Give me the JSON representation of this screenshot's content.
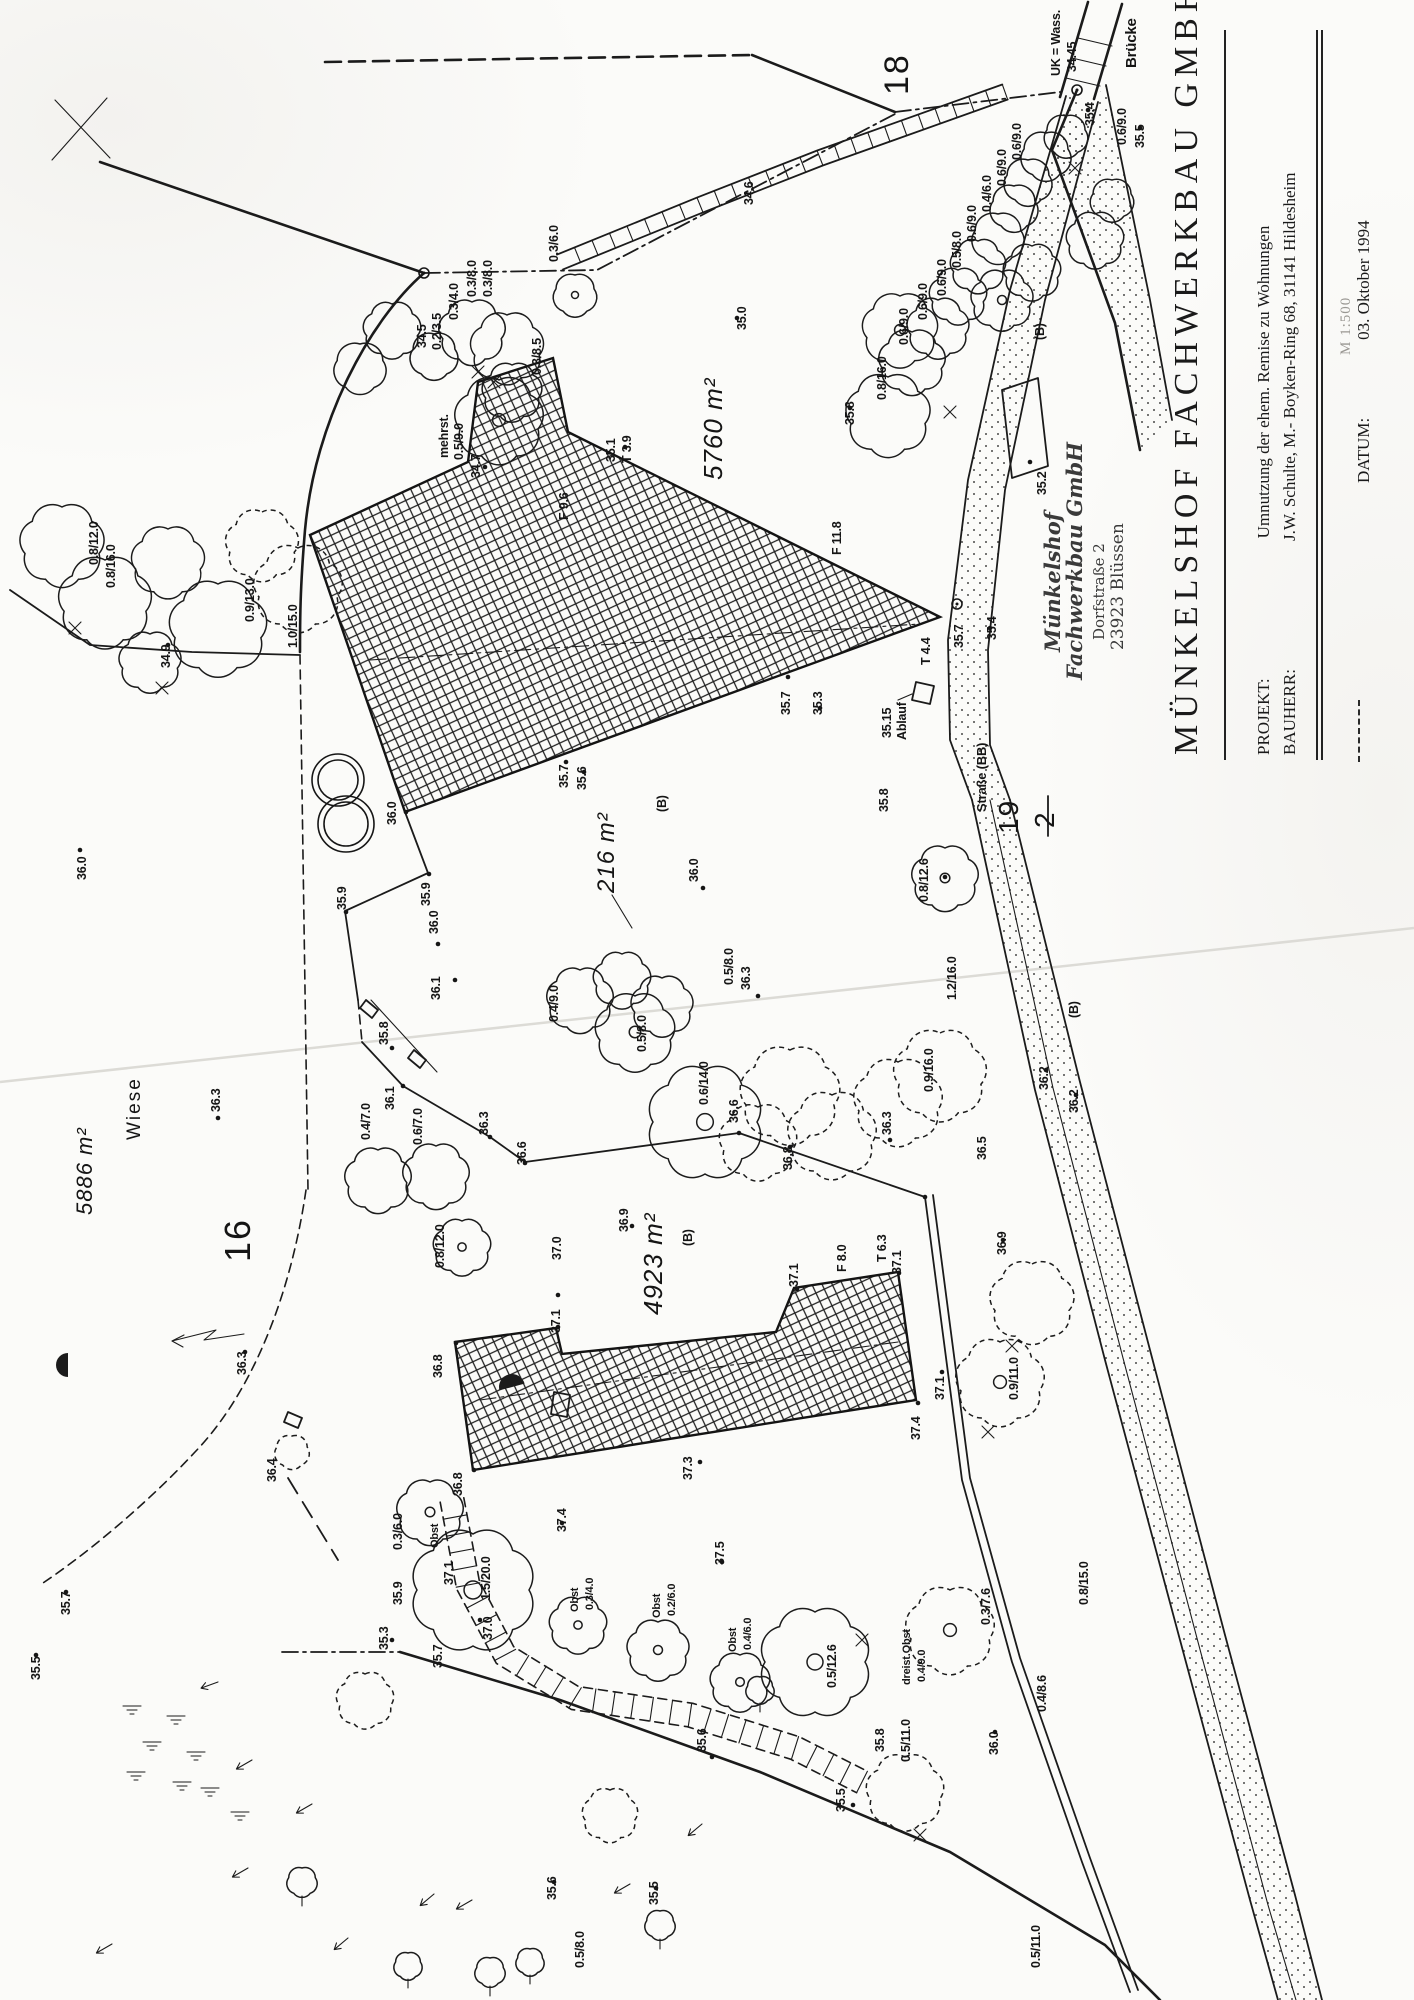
{
  "document": {
    "type": "Lageplan / site plan scan",
    "colors": {
      "ink": "#1b1b1b",
      "paper": "#fbfbf9",
      "stamp": "#3a3a3a"
    }
  },
  "title_block": {
    "company": "MÜNKELSHOF FACHWERKBAU GMBH",
    "rows": [
      {
        "label": "PROJEKT:",
        "value": "Umnutzung der ehem. Remise zu Wohnungen"
      },
      {
        "label": "BAUHERR:",
        "value": "J.W. Schulte, M.- Boyken-Ring 68, 31141 Hildesheim"
      }
    ],
    "scale_note": "M 1:500",
    "datum_label": "DATUM:",
    "datum_value": "03. Oktober 1994"
  },
  "stamp": {
    "line1": "Münkelshof",
    "line2": "Fachwerkbau GmbH",
    "line3": "Dorfstraße 2",
    "line4": "23923 Blüssen"
  },
  "map": {
    "parcels": [
      "18",
      "16",
      "19/2"
    ],
    "areas": [
      "5760 m²",
      "216 m²",
      "4923 m²",
      "5886 m²"
    ],
    "fraction": {
      "num": "19",
      "den": "2",
      "x": 1018,
      "y": 834
    },
    "labels": [
      {
        "t": "UK = Wass.",
        "x": 1060,
        "y": 76
      },
      {
        "t": "34.45",
        "x": 1076,
        "y": 72
      },
      {
        "t": "Brücke",
        "x": 1136,
        "y": 68,
        "s": 15
      },
      {
        "t": "35.4",
        "x": 1094,
        "y": 126
      },
      {
        "t": "35.5",
        "x": 1144,
        "y": 148
      },
      {
        "t": "0.6/9.0",
        "x": 1126,
        "y": 145
      },
      {
        "t": "18",
        "x": 908,
        "y": 95,
        "s": 34,
        "c": "big"
      },
      {
        "t": "34.6",
        "x": 753,
        "y": 205
      },
      {
        "t": "35.0",
        "x": 746,
        "y": 330
      },
      {
        "t": "0.3/6.0",
        "x": 558,
        "y": 262
      },
      {
        "t": "0.3/8.0",
        "x": 476,
        "y": 297
      },
      {
        "t": "0.3/8.0",
        "x": 492,
        "y": 297
      },
      {
        "t": "0.3/4.0",
        "x": 458,
        "y": 320
      },
      {
        "t": "34.5",
        "x": 426,
        "y": 348
      },
      {
        "t": "0.2/3.5",
        "x": 441,
        "y": 350
      },
      {
        "t": "0.3/8.5",
        "x": 541,
        "y": 375
      },
      {
        "t": "mehrst.",
        "x": 448,
        "y": 458
      },
      {
        "t": "0.5/9.0",
        "x": 463,
        "y": 460
      },
      {
        "t": "34.7",
        "x": 480,
        "y": 478
      },
      {
        "t": "35.1",
        "x": 615,
        "y": 462
      },
      {
        "t": "T 3.9",
        "x": 631,
        "y": 463
      },
      {
        "t": "F 9.6",
        "x": 568,
        "y": 520
      },
      {
        "t": "F 11.8",
        "x": 841,
        "y": 555
      },
      {
        "t": "T 4.4",
        "x": 930,
        "y": 665
      },
      {
        "t": "5760 m²",
        "x": 722,
        "y": 480,
        "s": 26,
        "c": "area"
      },
      {
        "t": "35.7",
        "x": 568,
        "y": 788
      },
      {
        "t": "35.6",
        "x": 586,
        "y": 790
      },
      {
        "t": "216 m²",
        "x": 614,
        "y": 893,
        "s": 24,
        "c": "area"
      },
      {
        "t": "(B)",
        "x": 666,
        "y": 812
      },
      {
        "t": "36.0",
        "x": 698,
        "y": 882
      },
      {
        "t": "35.7",
        "x": 790,
        "y": 715
      },
      {
        "t": "35.3",
        "x": 822,
        "y": 715
      },
      {
        "t": "35.15",
        "x": 891,
        "y": 738
      },
      {
        "t": "Ablauf",
        "x": 906,
        "y": 740
      },
      {
        "t": "35.7",
        "x": 963,
        "y": 648
      },
      {
        "t": "35.8",
        "x": 888,
        "y": 812
      },
      {
        "t": "Straße  (BB)",
        "x": 986,
        "y": 812,
        "s": 13
      },
      {
        "t": "35.2",
        "x": 1046,
        "y": 495
      },
      {
        "t": "(B)",
        "x": 1044,
        "y": 340
      },
      {
        "t": "35.4",
        "x": 996,
        "y": 640
      },
      {
        "t": "0.6/9.0",
        "x": 908,
        "y": 345
      },
      {
        "t": "0.6/9.0",
        "x": 927,
        "y": 320
      },
      {
        "t": "0.6/9.0",
        "x": 946,
        "y": 296
      },
      {
        "t": "0.5/8.0",
        "x": 961,
        "y": 268
      },
      {
        "t": "0.6/9.0",
        "x": 976,
        "y": 242
      },
      {
        "t": "0.4/6.0",
        "x": 991,
        "y": 212
      },
      {
        "t": "0.6/9.0",
        "x": 1006,
        "y": 186
      },
      {
        "t": "0.6/9.0",
        "x": 1021,
        "y": 160
      },
      {
        "t": "0.8/16.0",
        "x": 886,
        "y": 400
      },
      {
        "t": "35.8",
        "x": 854,
        "y": 425
      },
      {
        "t": "0.8/12.0",
        "x": 98,
        "y": 565
      },
      {
        "t": "0.8/16.0",
        "x": 115,
        "y": 588
      },
      {
        "t": "0.9/13.0",
        "x": 254,
        "y": 622
      },
      {
        "t": "1.0/15.0",
        "x": 297,
        "y": 648
      },
      {
        "t": "34.9",
        "x": 170,
        "y": 668
      },
      {
        "t": "36.0",
        "x": 86,
        "y": 880
      },
      {
        "t": "35.9",
        "x": 346,
        "y": 910
      },
      {
        "t": "35.9",
        "x": 430,
        "y": 906
      },
      {
        "t": "36.0",
        "x": 396,
        "y": 825
      },
      {
        "t": "36.0",
        "x": 438,
        "y": 934
      },
      {
        "t": "36.1",
        "x": 440,
        "y": 1000
      },
      {
        "t": "35.8",
        "x": 388,
        "y": 1045
      },
      {
        "t": "36.1",
        "x": 394,
        "y": 1110
      },
      {
        "t": "0.4/7.0",
        "x": 370,
        "y": 1140
      },
      {
        "t": "0.6/7.0",
        "x": 422,
        "y": 1145
      },
      {
        "t": "36.3",
        "x": 488,
        "y": 1135
      },
      {
        "t": "36.6",
        "x": 526,
        "y": 1165
      },
      {
        "t": "36.6",
        "x": 738,
        "y": 1123
      },
      {
        "t": "0.4/9.0",
        "x": 558,
        "y": 1022
      },
      {
        "t": "0.5/8.0",
        "x": 646,
        "y": 1052
      },
      {
        "t": "0.6/14.0",
        "x": 708,
        "y": 1105
      },
      {
        "t": "36.3",
        "x": 750,
        "y": 990
      },
      {
        "t": "0.5/8.0",
        "x": 733,
        "y": 985
      },
      {
        "t": "0.8/12.6",
        "x": 928,
        "y": 902
      },
      {
        "t": "1.2/16.0",
        "x": 956,
        "y": 1000
      },
      {
        "t": "0.9/16.0",
        "x": 933,
        "y": 1092
      },
      {
        "t": "36.2",
        "x": 1048,
        "y": 1090
      },
      {
        "t": "36.2",
        "x": 1078,
        "y": 1113
      },
      {
        "t": "(B)",
        "x": 1078,
        "y": 1018
      },
      {
        "t": "Wiese",
        "x": 140,
        "y": 1140,
        "s": 19,
        "c": "big"
      },
      {
        "t": "5886 m²",
        "x": 92,
        "y": 1215,
        "s": 22,
        "c": "area"
      },
      {
        "t": "16",
        "x": 250,
        "y": 1262,
        "s": 36,
        "c": "big"
      },
      {
        "t": "36.3",
        "x": 220,
        "y": 1112
      },
      {
        "t": "36.3",
        "x": 246,
        "y": 1375
      },
      {
        "t": "4923 m²",
        "x": 662,
        "y": 1315,
        "s": 26,
        "c": "area"
      },
      {
        "t": "36.9",
        "x": 628,
        "y": 1232
      },
      {
        "t": "(B)",
        "x": 692,
        "y": 1246
      },
      {
        "t": "0.8/12.0",
        "x": 444,
        "y": 1268
      },
      {
        "t": "37.0",
        "x": 561,
        "y": 1260
      },
      {
        "t": "37.1",
        "x": 560,
        "y": 1333
      },
      {
        "t": "36.8",
        "x": 442,
        "y": 1378
      },
      {
        "t": "36.8",
        "x": 462,
        "y": 1496
      },
      {
        "t": "37.3",
        "x": 692,
        "y": 1480
      },
      {
        "t": "37.1",
        "x": 798,
        "y": 1287
      },
      {
        "t": "F 8.0",
        "x": 846,
        "y": 1272
      },
      {
        "t": "T 6.3",
        "x": 886,
        "y": 1262
      },
      {
        "t": "37.1",
        "x": 901,
        "y": 1274
      },
      {
        "t": "37.4",
        "x": 920,
        "y": 1440
      },
      {
        "t": "37.1",
        "x": 944,
        "y": 1400
      },
      {
        "t": "0.9/11.0",
        "x": 1018,
        "y": 1400
      },
      {
        "t": "36.3",
        "x": 891,
        "y": 1135
      },
      {
        "t": "36.5",
        "x": 986,
        "y": 1160
      },
      {
        "t": "36.9",
        "x": 1006,
        "y": 1255
      },
      {
        "t": "36.8",
        "x": 792,
        "y": 1170
      },
      {
        "t": "36.4",
        "x": 276,
        "y": 1482
      },
      {
        "t": "35.7",
        "x": 70,
        "y": 1615
      },
      {
        "t": "35.5",
        "x": 40,
        "y": 1680
      },
      {
        "t": "0.3/6.0",
        "x": 402,
        "y": 1550
      },
      {
        "t": "Obst",
        "x": 438,
        "y": 1548,
        "s": 11
      },
      {
        "t": "1.5/20.0",
        "x": 490,
        "y": 1600
      },
      {
        "t": "37.1",
        "x": 453,
        "y": 1585
      },
      {
        "t": "37.0",
        "x": 492,
        "y": 1640
      },
      {
        "t": "35.9",
        "x": 402,
        "y": 1605
      },
      {
        "t": "35.3",
        "x": 388,
        "y": 1650
      },
      {
        "t": "35.7",
        "x": 442,
        "y": 1668
      },
      {
        "t": "37.4",
        "x": 566,
        "y": 1532
      },
      {
        "t": "Obst",
        "x": 578,
        "y": 1612,
        "s": 11
      },
      {
        "t": "0.3/4.0",
        "x": 593,
        "y": 1610,
        "s": 11
      },
      {
        "t": "37.5",
        "x": 724,
        "y": 1565
      },
      {
        "t": "Obst",
        "x": 660,
        "y": 1618,
        "s": 11
      },
      {
        "t": "0.2/6.0",
        "x": 675,
        "y": 1616,
        "s": 11
      },
      {
        "t": "Obst",
        "x": 736,
        "y": 1652,
        "s": 11
      },
      {
        "t": "0.4/6.0",
        "x": 751,
        "y": 1650,
        "s": 11
      },
      {
        "t": "0.5/12.6",
        "x": 836,
        "y": 1688
      },
      {
        "t": "dreist.Obst",
        "x": 910,
        "y": 1685,
        "s": 11
      },
      {
        "t": "0.4/9.0",
        "x": 925,
        "y": 1682,
        "s": 11
      },
      {
        "t": "35.6",
        "x": 706,
        "y": 1752
      },
      {
        "t": "35.8",
        "x": 884,
        "y": 1752
      },
      {
        "t": "0.5/11.0",
        "x": 910,
        "y": 1762
      },
      {
        "t": "35.5",
        "x": 845,
        "y": 1812
      },
      {
        "t": "0.3/7.6",
        "x": 990,
        "y": 1625
      },
      {
        "t": "0.8/15.0",
        "x": 1088,
        "y": 1605
      },
      {
        "t": "0.4/8.6",
        "x": 1046,
        "y": 1712
      },
      {
        "t": "36.0",
        "x": 998,
        "y": 1755
      },
      {
        "t": "35.6",
        "x": 556,
        "y": 1900
      },
      {
        "t": "35.5",
        "x": 658,
        "y": 1905
      },
      {
        "t": "0.5/8.0",
        "x": 584,
        "y": 1968
      },
      {
        "t": "0.5/11.0",
        "x": 1040,
        "y": 1968
      }
    ],
    "points": [
      [
        737,
        318
      ],
      [
        485,
        467
      ],
      [
        625,
        447
      ],
      [
        566,
        762
      ],
      [
        584,
        772
      ],
      [
        703,
        888
      ],
      [
        788,
        677
      ],
      [
        820,
        708
      ],
      [
        850,
        408
      ],
      [
        168,
        645
      ],
      [
        80,
        850
      ],
      [
        346,
        912
      ],
      [
        429,
        874
      ],
      [
        406,
        812
      ],
      [
        438,
        944
      ],
      [
        455,
        980
      ],
      [
        392,
        1048
      ],
      [
        403,
        1086
      ],
      [
        490,
        1137
      ],
      [
        525,
        1163
      ],
      [
        739,
        1133
      ],
      [
        758,
        996
      ],
      [
        632,
        1226
      ],
      [
        218,
        1118
      ],
      [
        245,
        1352
      ],
      [
        890,
        1140
      ],
      [
        1003,
        1240
      ],
      [
        1046,
        1070
      ],
      [
        1076,
        1095
      ],
      [
        790,
        1147
      ],
      [
        558,
        1295
      ],
      [
        558,
        1327
      ],
      [
        456,
        1343
      ],
      [
        474,
        1470
      ],
      [
        700,
        1462
      ],
      [
        797,
        1289
      ],
      [
        899,
        1273
      ],
      [
        918,
        1403
      ],
      [
        942,
        1372
      ],
      [
        722,
        1562
      ],
      [
        712,
        1757
      ],
      [
        853,
        1805
      ],
      [
        995,
        1732
      ],
      [
        392,
        1640
      ],
      [
        480,
        1620
      ],
      [
        562,
        1523
      ],
      [
        1030,
        462
      ],
      [
        990,
        628
      ],
      [
        1088,
        110
      ],
      [
        1140,
        128
      ],
      [
        36,
        1655
      ],
      [
        66,
        1592
      ],
      [
        554,
        1882
      ],
      [
        656,
        1888
      ],
      [
        925,
        1197
      ],
      [
        945,
        877
      ]
    ],
    "rings": [
      [
        957,
        604,
        5
      ],
      [
        1077,
        90,
        5
      ],
      [
        424,
        273,
        5
      ]
    ],
    "trees": [
      [
        62,
        545,
        38
      ],
      [
        105,
        602,
        42
      ],
      [
        168,
        562,
        33
      ],
      [
        218,
        628,
        44
      ],
      [
        262,
        545,
        33,
        "d"
      ],
      [
        298,
        588,
        40,
        "d"
      ],
      [
        150,
        662,
        28
      ],
      [
        472,
        332,
        30
      ],
      [
        507,
        348,
        33
      ],
      [
        512,
        392,
        27
      ],
      [
        499,
        420,
        40,
        "s",
        1
      ],
      [
        434,
        356,
        22
      ],
      [
        575,
        295,
        20,
        "s",
        1
      ],
      [
        392,
        330,
        26
      ],
      [
        360,
        368,
        24
      ],
      [
        888,
        415,
        38
      ],
      [
        900,
        330,
        34,
        "s",
        1
      ],
      [
        912,
        362,
        30
      ],
      [
        938,
        328,
        28
      ],
      [
        958,
        296,
        26
      ],
      [
        978,
        266,
        25
      ],
      [
        998,
        238,
        24
      ],
      [
        1014,
        208,
        22
      ],
      [
        1028,
        182,
        22
      ],
      [
        1046,
        156,
        23
      ],
      [
        1066,
        136,
        20
      ],
      [
        1002,
        300,
        28,
        "s",
        1
      ],
      [
        1032,
        272,
        26
      ],
      [
        1095,
        240,
        26
      ],
      [
        1112,
        200,
        20
      ],
      [
        945,
        878,
        30,
        "s",
        1
      ],
      [
        940,
        1075,
        42,
        "d"
      ],
      [
        898,
        1102,
        40,
        "d"
      ],
      [
        790,
        1095,
        45,
        "d"
      ],
      [
        832,
        1135,
        40,
        "d"
      ],
      [
        758,
        1142,
        35,
        "d"
      ],
      [
        378,
        1180,
        30
      ],
      [
        436,
        1176,
        30
      ],
      [
        462,
        1247,
        26,
        "s",
        1
      ],
      [
        635,
        1032,
        36,
        "s",
        1
      ],
      [
        705,
        1122,
        52,
        "s",
        1
      ],
      [
        580,
        1000,
        30
      ],
      [
        622,
        980,
        26
      ],
      [
        662,
        1006,
        28
      ],
      [
        1000,
        1382,
        40,
        "d",
        1
      ],
      [
        1032,
        1302,
        38,
        "d"
      ],
      [
        430,
        1512,
        30,
        "s",
        1
      ],
      [
        473,
        1590,
        56,
        "s",
        1
      ],
      [
        578,
        1625,
        26,
        "s",
        1
      ],
      [
        658,
        1650,
        28,
        "s",
        1
      ],
      [
        740,
        1682,
        27,
        "s",
        1
      ],
      [
        815,
        1662,
        50,
        "s",
        1
      ],
      [
        950,
        1630,
        40,
        "d",
        1
      ],
      [
        905,
        1792,
        35,
        "d"
      ],
      [
        365,
        1700,
        26,
        "d"
      ],
      [
        610,
        1815,
        25,
        "d"
      ],
      [
        292,
        1452,
        16,
        "d"
      ],
      [
        302,
        1882,
        14
      ],
      [
        490,
        1972,
        14
      ],
      [
        660,
        1925,
        14
      ],
      [
        530,
        1962,
        13
      ],
      [
        760,
        1690,
        13
      ],
      [
        408,
        1966,
        13
      ]
    ],
    "xmarks": [
      [
        75,
        628
      ],
      [
        162,
        688
      ],
      [
        478,
        372
      ],
      [
        494,
        382
      ],
      [
        950,
        412
      ],
      [
        1075,
        168
      ],
      [
        862,
        1640
      ],
      [
        920,
        1835
      ],
      [
        1012,
        1346
      ],
      [
        988,
        1432
      ]
    ],
    "arrows": [
      [
        218,
        1682,
        160
      ],
      [
        252,
        1760,
        150
      ],
      [
        312,
        1804,
        150
      ],
      [
        434,
        1894,
        140
      ],
      [
        472,
        1900,
        150
      ],
      [
        630,
        1884,
        150
      ],
      [
        702,
        1824,
        140
      ],
      [
        112,
        1944,
        150
      ],
      [
        348,
        1938,
        140
      ],
      [
        248,
        1868,
        150
      ]
    ],
    "marsh": [
      [
        132,
        1706
      ],
      [
        176,
        1716
      ],
      [
        152,
        1742
      ],
      [
        196,
        1752
      ],
      [
        136,
        1772
      ],
      [
        182,
        1782
      ],
      [
        240,
        1812
      ],
      [
        210,
        1788
      ]
    ]
  }
}
